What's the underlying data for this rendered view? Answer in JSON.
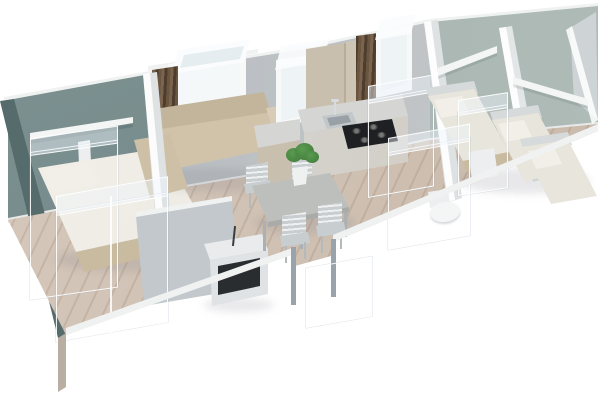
{
  "scene": {
    "label": "3D cutaway floor plan render of a mobile home interior",
    "width": 600,
    "height": 400,
    "view": "isometric-front-top"
  },
  "palette": {
    "background": "#ffffff",
    "wall_gray": "#b5babe",
    "wall_gray_light": "#c6cacc",
    "wall_sage_left": "#7e9292",
    "wall_sage_right": "#a2b0ac",
    "wall_rim": "#f0f2f2",
    "left_wall_dark": "#566b6c",
    "baseboard": "#e8eaea",
    "floor_wood": "#d6c9bc",
    "floor_wood_dark": "#c8b8a9",
    "front_wood": "#cdc3b8",
    "partition": "#dfe2e3",
    "partition_gray": "#c2c8cc",
    "sofa": "#d0c3aa",
    "sofa_dark": "#c3b59b",
    "linen": "#e8e5dc",
    "pillow": "#f1efe8",
    "bed_base": "#c9bb9f",
    "headboard": "#d7dadb",
    "shelf": "#f4f5f5",
    "counter": "#d5d5d3",
    "cabinet_wood": "#c9bfae",
    "cabinet_front": "#d9dadb",
    "hob": "#1e2023",
    "steel": "#c2c7ca",
    "steel_dark": "#9aa1a6",
    "chair": "#c8cdd0",
    "chair_slat": "#eef0f1",
    "table": "#bdbfbc",
    "table_edge": "#a9aba8",
    "plant": "#3e7a3a",
    "plant_light": "#5a9a50",
    "pot": "#eff1f1",
    "curtain": "#6a563f",
    "curtain_dark": "#4e3d2c",
    "window_glass": "#eef3f5",
    "window_frame": "#f7f8f8",
    "ghost_fill": "rgba(226,237,246,0.32)",
    "ghost_top": "rgba(240,247,252,0.45)",
    "ghost_edge": "rgba(255,255,255,0.9)",
    "door_frame": "#99a3ab",
    "shadow": "rgba(110,115,125,0.16)",
    "tv_opening": "#2a2d30",
    "white_box": "#eceeef"
  },
  "rooms": [
    {
      "name": "master-bedroom",
      "items": [
        "double-bed",
        "wall-shelf",
        "ghost-wardrobe"
      ]
    },
    {
      "name": "bathroom",
      "items": [
        "ghost-shower-enclosure"
      ]
    },
    {
      "name": "living-area",
      "items": [
        "corner-sofa",
        "curtained-window",
        "tv-cabinet"
      ]
    },
    {
      "name": "dining-area",
      "items": [
        "dining-table",
        "four-chairs",
        "plant"
      ]
    },
    {
      "name": "kitchen",
      "items": [
        "sink",
        "gas-hob-4-burners",
        "upper-cabinet",
        "tall-cabinet",
        "window",
        "ghost-fridge"
      ]
    },
    {
      "name": "wc",
      "items": [
        "toilet",
        "ghost-partition"
      ]
    },
    {
      "name": "bedroom-2",
      "items": [
        "single-bed",
        "wall-shelf"
      ]
    },
    {
      "name": "bedroom-3",
      "items": [
        "twin-bed",
        "twin-bed",
        "wall-shelf",
        "ghost-wardrobe",
        "nightstand"
      ]
    }
  ],
  "entrance": {
    "type": "door-opening",
    "location": "front-wall-center",
    "items": [
      "ghost-steps"
    ]
  }
}
